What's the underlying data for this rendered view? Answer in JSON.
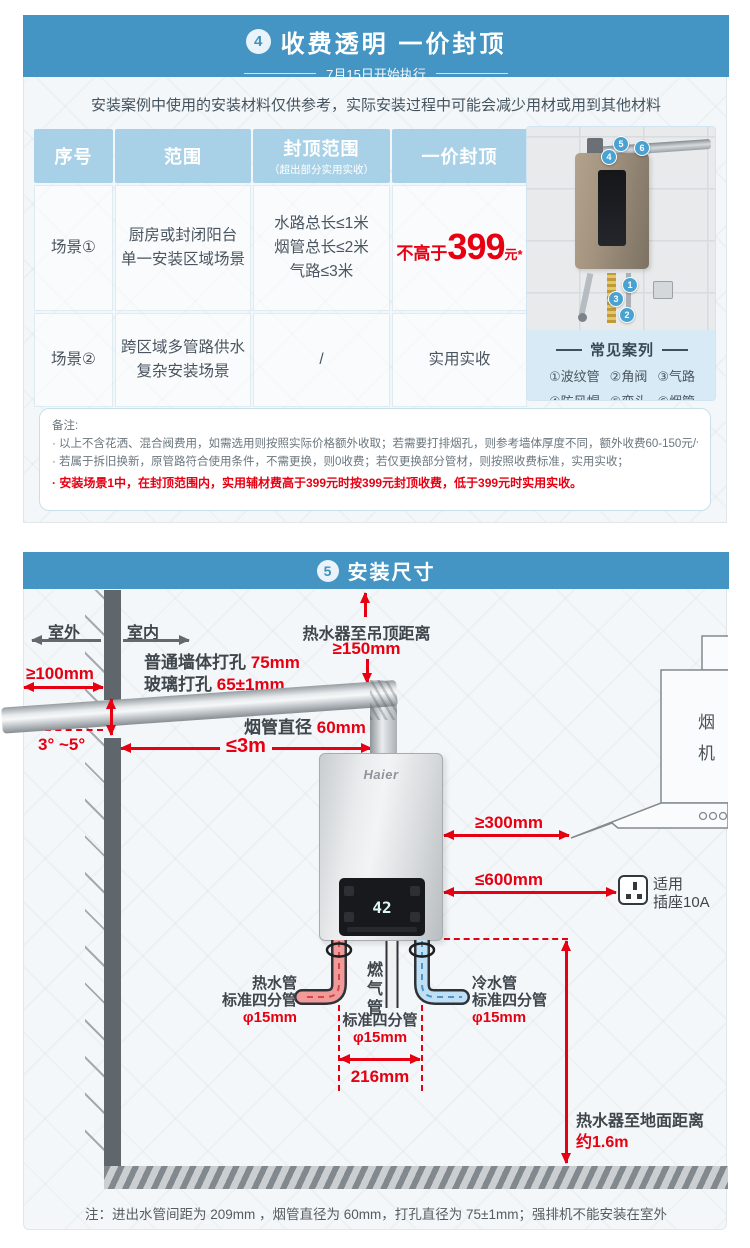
{
  "colors": {
    "banner_blue": "#4495C3",
    "accent_red": "#E60012",
    "table_header_blue": "#A8D1E7"
  },
  "s4": {
    "badge": "4",
    "title": "收费透明  一价封顶",
    "subtitle": "7月15日开始执行",
    "intro": "安装案例中使用的安装材料仅供参考，实际安装过程中可能会减少用材或用到其他材料",
    "table": {
      "col_no": "序号",
      "col_scope": "范围",
      "col_cap": "封顶范围",
      "col_cap_sub": "（超出部分实用实收）",
      "col_price": "一价封顶",
      "r1_no": "场景①",
      "r1_scope1": "厨房或封闭阳台",
      "r1_scope2": "单一安装区域场景",
      "r1_cap1": "水路总长≤1米",
      "r1_cap2": "烟管总长≤2米",
      "r1_cap3": "气路≤3米",
      "r1_price_prefix": "不高于",
      "r1_price": "399",
      "r1_price_suffix": "元*",
      "r2_no": "场景②",
      "r2_scope1": "跨区域多管路供水",
      "r2_scope2": "复杂安装场景",
      "r2_cap": "/",
      "r2_price": "实用实收"
    },
    "photo": {
      "caption": "常见案列",
      "legend": [
        "①波纹管",
        "②角阀",
        "③气路",
        "④防风帽",
        "⑤弯头",
        "⑥烟管"
      ],
      "markers": [
        "1",
        "2",
        "3",
        "4",
        "5",
        "6"
      ]
    },
    "notes": {
      "title": "备注:",
      "l1": "· 以上不含花洒、混合阀费用，如需选用则按照实际价格额外收取；若需要打排烟孔，则参考墙体厚度不同，额外收费60-150元/个；",
      "l2": "· 若属于拆旧换新，原管路符合使用条件，不需更换，则0收费；若仅更换部分管材，则按照收费标准，实用实收；",
      "l3": "· 安装场景1中，在封顶范围内，实用辅材费高于399元时按399元封顶收费，低于399元时实用实收。"
    }
  },
  "s5": {
    "badge": "5",
    "title": "安装尺寸",
    "outdoor": "室外",
    "indoor": "室内",
    "wall_hole_label": "普通墙体打孔",
    "wall_hole_value": "75mm",
    "glass_hole_label": "玻璃打孔",
    "glass_hole_value": "65±1mm",
    "left_clearance": "≥100mm",
    "angle": "3°  ~5°",
    "flue_d_label": "烟管直径",
    "flue_d_value": "60mm",
    "flue_len": "≤3m",
    "ceiling_label": "热水器至吊顶距离",
    "ceiling_value": "≥150mm",
    "hood": "烟机",
    "clear_hood": "≥300mm",
    "clear_socket": "≤600mm",
    "socket_l1": "适用",
    "socket_l2": "插座10A",
    "brand": "Haier",
    "temp": "42",
    "hot_1": "热水管",
    "hot_2": "标准四分管",
    "hot_3": "φ15mm",
    "gas_v": "燃气管",
    "gas_1": "标准四分管",
    "gas_2": "φ15mm",
    "cold_1": "冷水管",
    "cold_2": "标准四分管",
    "cold_3": "φ15mm",
    "span": "216mm",
    "floor_label": "热水器至地面距离",
    "floor_value": "约1.6m",
    "note": "注：进出水管间距为 209mm ，烟管直径为 60mm，打孔直径为 75±1mm；强排机不能安装在室外"
  }
}
